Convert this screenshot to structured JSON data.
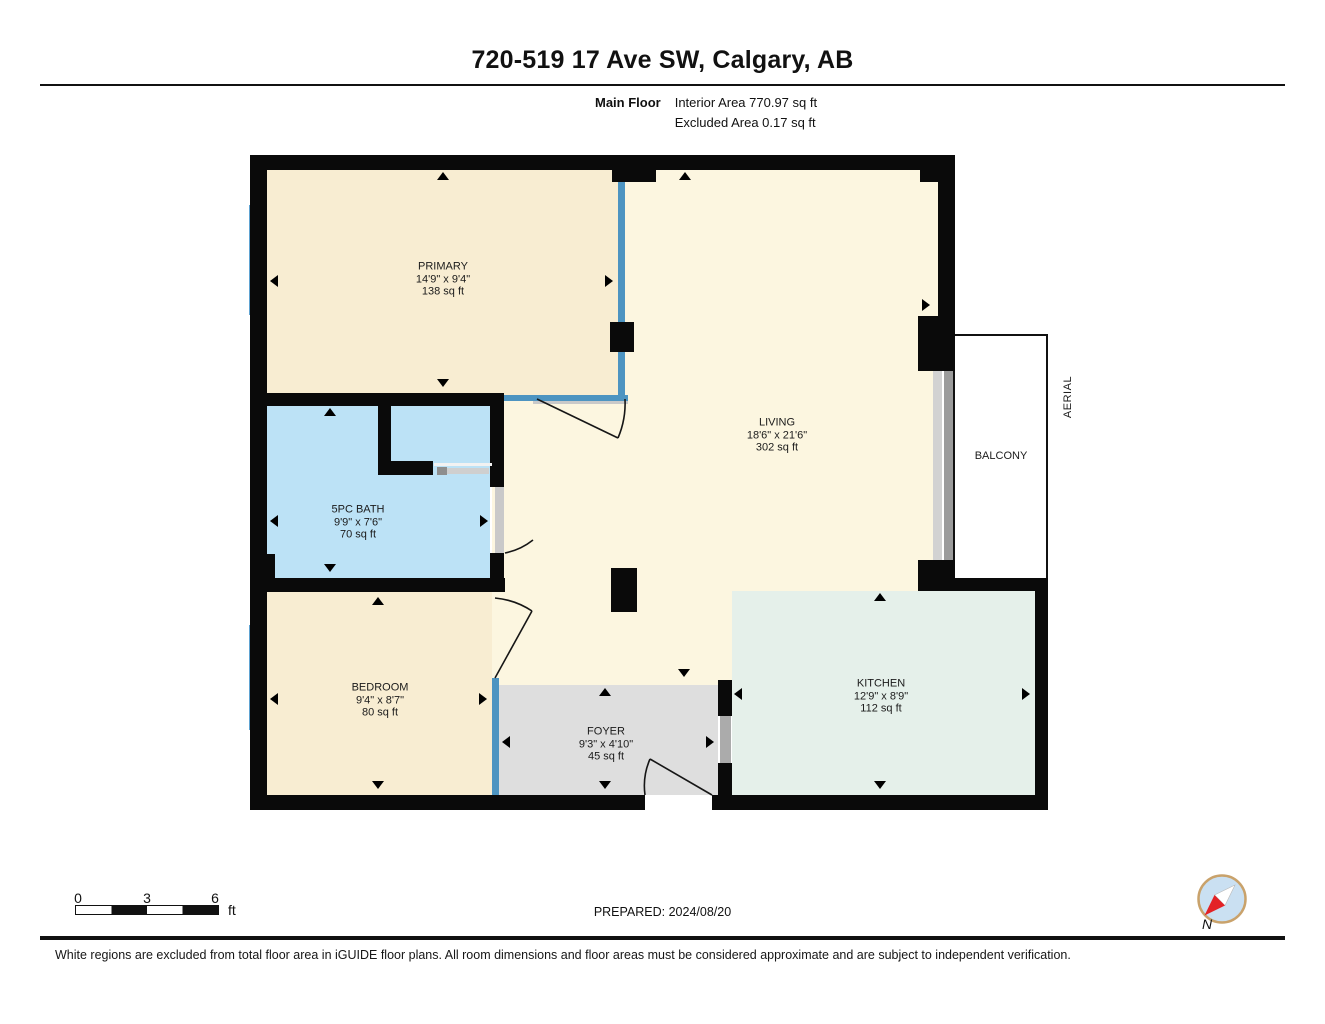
{
  "header": {
    "title": "720-519 17 Ave SW, Calgary, AB",
    "floor_label": "Main Floor",
    "interior_area": "Interior Area 770.97 sq ft",
    "excluded_area": "Excluded Area 0.17 sq ft"
  },
  "plan": {
    "rooms": {
      "primary": {
        "name": "PRIMARY",
        "dims": "14'9\" x 9'4\"",
        "area": "138 sq ft"
      },
      "living": {
        "name": "LIVING",
        "dims": "18'6\" x 21'6\"",
        "area": "302 sq ft"
      },
      "bath": {
        "name": "5PC BATH",
        "dims": "9'9\" x 7'6\"",
        "area": "70 sq ft"
      },
      "bedroom": {
        "name": "BEDROOM",
        "dims": "9'4\" x 8'7\"",
        "area": "80 sq ft"
      },
      "foyer": {
        "name": "FOYER",
        "dims": "9'3\" x 4'10\"",
        "area": "45 sq ft"
      },
      "kitchen": {
        "name": "KITCHEN",
        "dims": "12'9\" x 8'9\"",
        "area": "112 sq ft"
      }
    },
    "balcony_label": "BALCONY",
    "aerial_label": "AERIAL"
  },
  "scale_bar": {
    "ticks": [
      "0",
      "3",
      "6"
    ],
    "unit": "ft"
  },
  "compass": {
    "north_label": "N"
  },
  "footer": {
    "prepared": "PREPARED: 2024/08/20",
    "disclaimer": "White regions are excluded from total floor area in iGUIDE floor plans. All room dimensions and floor areas must be considered approximate and are subject to independent verification."
  },
  "colors": {
    "wall": "#0a0a0a",
    "primary_fill": "#F8EDD2",
    "living_fill": "#FCF6E0",
    "bath_fill": "#BCE2F6",
    "bedroom_fill": "#F8EDD2",
    "foyer_fill": "#DEDEDE",
    "kitchen_fill": "#E5F0EA",
    "window_blue": "#4D94C1",
    "door_gray": "#C9C9C9"
  }
}
